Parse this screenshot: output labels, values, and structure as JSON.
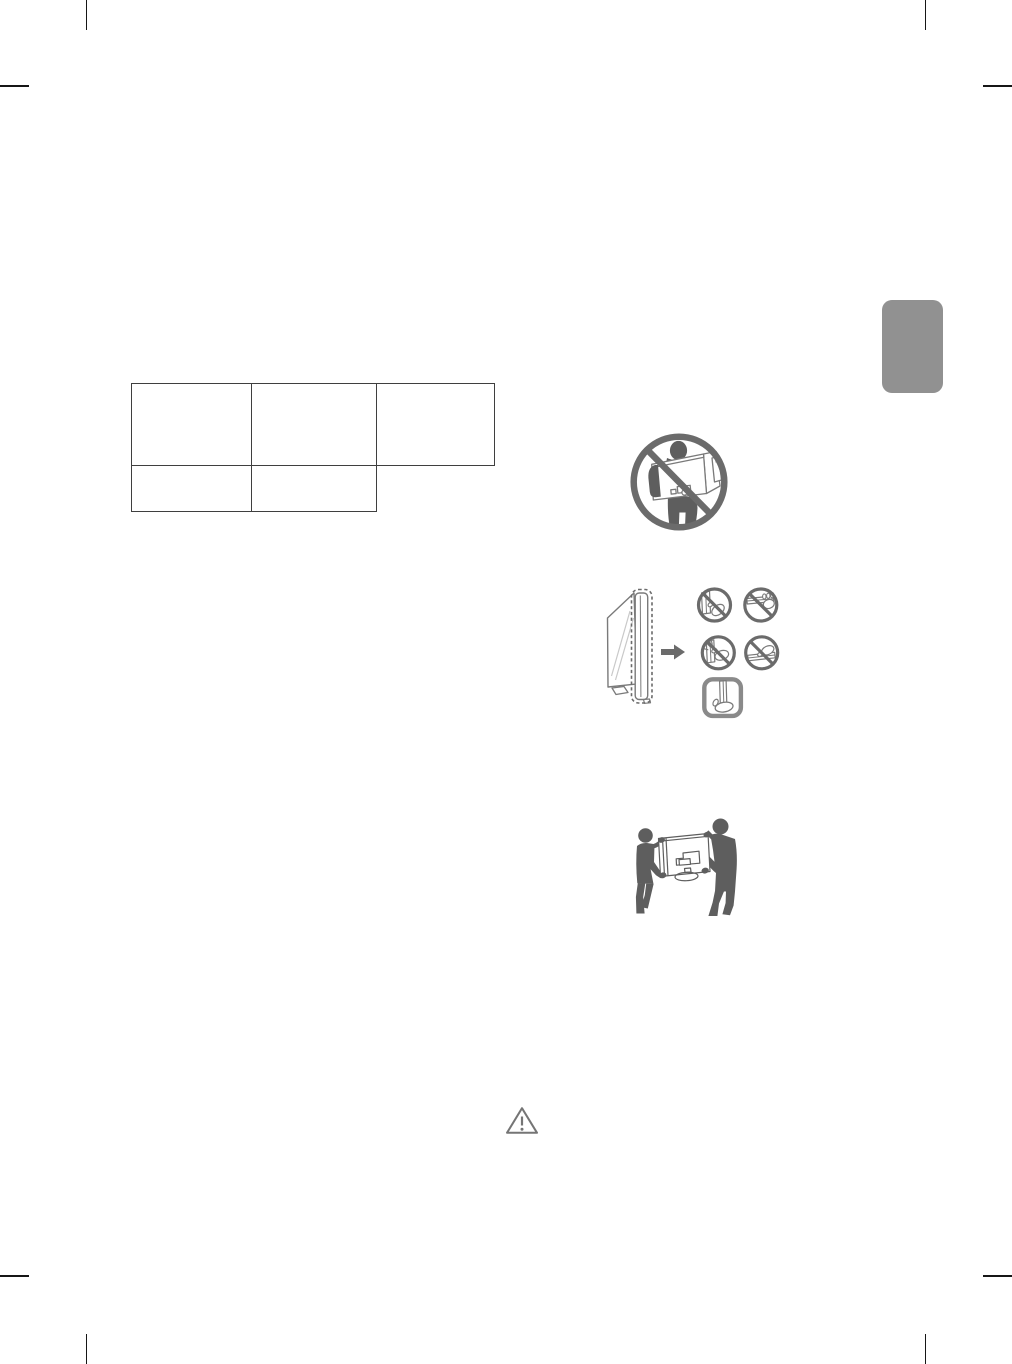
{
  "page": {
    "background": "#ffffff"
  },
  "colors": {
    "page_background": "#ffffff",
    "crop_mark": "#161616",
    "table_border": "#3f3f3f",
    "section_tab": "#919191",
    "illustration": "#6b6b6b",
    "silhouette": "#5e5e5e",
    "panel_outline": "#7a7a7a",
    "panel_fill": "#ffffff",
    "sheen": "#c9c9c9",
    "caution": "#757575"
  },
  "table": {
    "rows": [
      {
        "cells": [
          "",
          "",
          ""
        ]
      },
      {
        "cells": [
          "",
          ""
        ]
      }
    ]
  },
  "section_tab": {
    "label": ""
  },
  "icons": [
    {
      "name": "no-carry-alone-icon"
    },
    {
      "name": "panel-side-view-icon"
    },
    {
      "name": "arrow-right-icon"
    },
    {
      "name": "no-touch-corner-icon"
    },
    {
      "name": "no-grip-top-edge-icon"
    },
    {
      "name": "no-press-screen-icon"
    },
    {
      "name": "no-grip-bottom-edge-icon"
    },
    {
      "name": "hold-bottom-frame-icon"
    },
    {
      "name": "two-person-carry-icon"
    },
    {
      "name": "caution-triangle-icon"
    }
  ]
}
